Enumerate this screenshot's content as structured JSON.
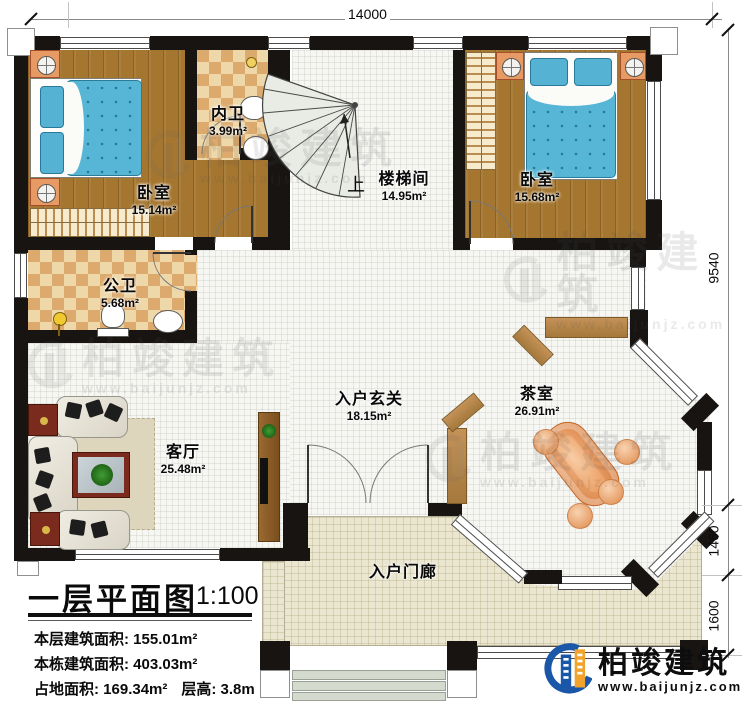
{
  "title_block": {
    "title": "一层平面图",
    "scale": "1:100",
    "line1": "本层建筑面积: 155.01m²",
    "line2": "本栋建筑面积: 403.03m²",
    "line3a": "占地面积: 169.34m²",
    "line3b": "层高: 3.8m"
  },
  "dimensions": {
    "top": "14000",
    "right_top": "9540",
    "right_middle": "1460",
    "right_bottom": "1600"
  },
  "rooms": {
    "bedroom_left": {
      "name": "卧室",
      "area": "15.14m²"
    },
    "bath_inner": {
      "name": "内卫",
      "area": "3.99m²"
    },
    "stairwell": {
      "name": "楼梯间",
      "area": "14.95m²",
      "up": "上"
    },
    "bedroom_right": {
      "name": "卧室",
      "area": "15.68m²"
    },
    "bath_public": {
      "name": "公卫",
      "area": "5.68m²"
    },
    "living": {
      "name": "客厅",
      "area": "25.48m²"
    },
    "foyer": {
      "name": "入户玄关",
      "area": "18.15m²"
    },
    "tea": {
      "name": "茶室",
      "area": "26.91m²"
    },
    "porch": {
      "name": "入户门廊"
    }
  },
  "brand": {
    "name": "柏竣建筑",
    "url": "www.baijunjz.com"
  },
  "watermark": {
    "name": "柏竣建筑",
    "url": "www.baijunjz.com"
  },
  "colors": {
    "wall": "#171412",
    "wood_floor": "#a5762f",
    "tile_floor": "#f6f6f3",
    "checker_light": "#eed7a8",
    "checker_dark": "#dcaa6d",
    "porch_floor": "#ebe6d0",
    "bed_blue": "#57b6d6",
    "nightstand_orange": "#e79a63",
    "table_red": "#7b2b1e",
    "screen_wood": "#b5854a",
    "tea_table_orange": "#eda56d",
    "brand_blue": "#1b57a8",
    "brand_orange": "#f2a32d"
  }
}
